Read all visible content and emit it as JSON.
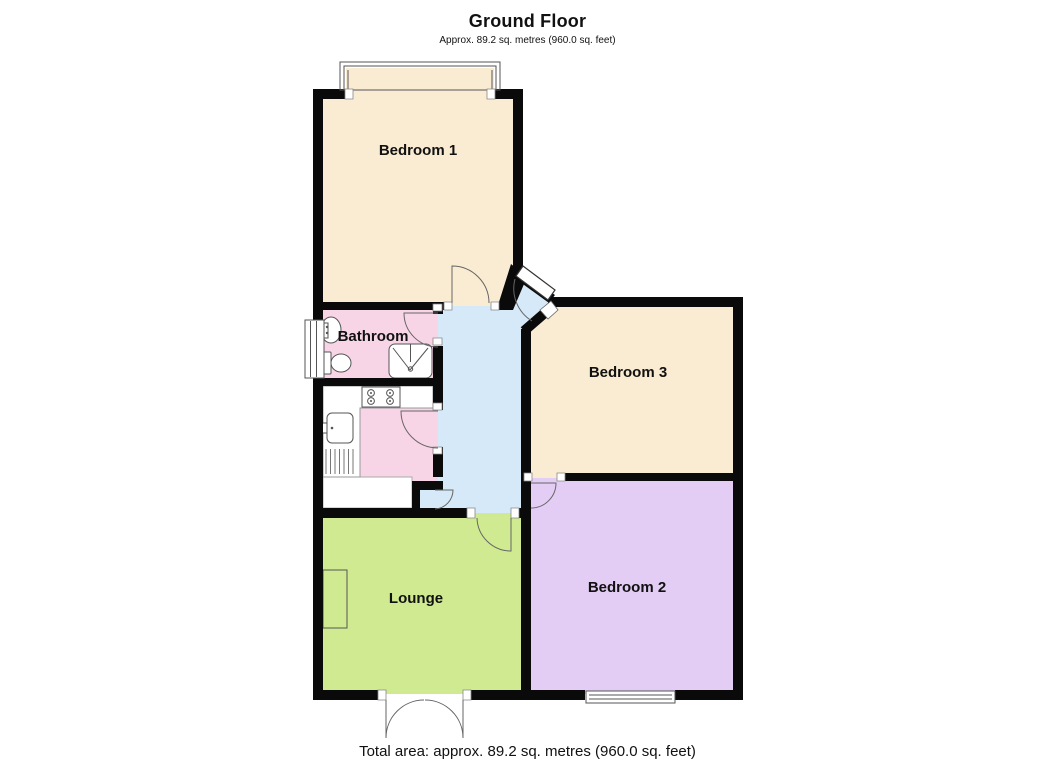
{
  "header": {
    "title": "Ground Floor",
    "subtitle": "Approx. 89.2 sq. metres (960.0 sq. feet)"
  },
  "footer": {
    "total_area": "Total area: approx. 89.2 sq. metres (960.0 sq. feet)"
  },
  "floorplan": {
    "wall_color": "#0a0a0a",
    "rooms": [
      {
        "id": "bedroom-1",
        "label": "Bedroom 1",
        "color": "#faecd2"
      },
      {
        "id": "bathroom",
        "label": "Bathroom",
        "color": "#f8d5e6"
      },
      {
        "id": "kitchen",
        "label": "",
        "color": "#f8d5e6"
      },
      {
        "id": "hallway",
        "label": "",
        "color": "#d6e9f8"
      },
      {
        "id": "bedroom-3",
        "label": "Bedroom 3",
        "color": "#faecd2"
      },
      {
        "id": "bedroom-2",
        "label": "Bedroom 2",
        "color": "#e3cdf4"
      },
      {
        "id": "lounge",
        "label": "Lounge",
        "color": "#cfea90"
      },
      {
        "id": "store",
        "label": "",
        "color": "#ffffff"
      }
    ],
    "features": [
      "bay-window",
      "side-window",
      "entrance-door",
      "bedroom2-window",
      "french-doors",
      "shower",
      "toilet",
      "bathroom-sink",
      "kitchen-sink",
      "drainer",
      "hob",
      "fireplace",
      "cupboard-door"
    ]
  }
}
